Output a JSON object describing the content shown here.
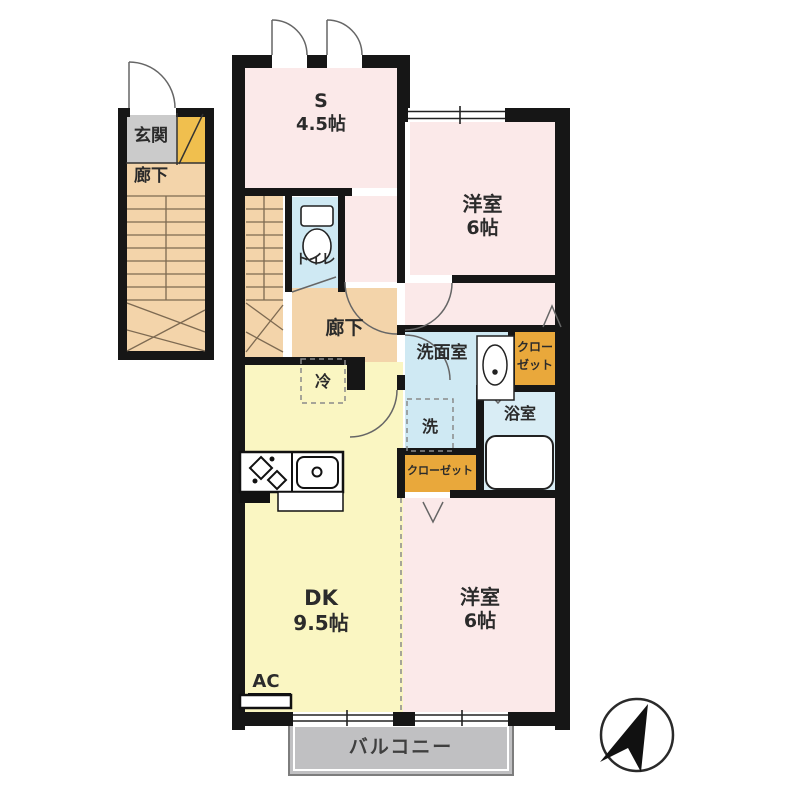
{
  "plan": {
    "type": "floorplan",
    "rooms": {
      "entrance": {
        "label": "玄関"
      },
      "entrance_hall": {
        "label": "廊下"
      },
      "service_room": {
        "name": "S",
        "size": "4.5帖"
      },
      "bedroom_top": {
        "name": "洋室",
        "size": "6帖"
      },
      "toilet": {
        "label": "トイレ"
      },
      "hallway": {
        "label": "廊下"
      },
      "washroom": {
        "label": "洗面室"
      },
      "closet_upper": {
        "label_line1": "クロー",
        "label_line2": "ゼット"
      },
      "bathroom": {
        "label": "浴室"
      },
      "laundry": {
        "label": "洗"
      },
      "refrigerator": {
        "label": "冷"
      },
      "closet_lower": {
        "label": "クローゼット"
      },
      "dining_kitchen": {
        "name": "DK",
        "size": "9.5帖"
      },
      "bedroom_bottom": {
        "name": "洋室",
        "size": "6帖"
      },
      "air_conditioner": {
        "label": "AC"
      },
      "balcony": {
        "label": "バルコニー"
      }
    },
    "colors": {
      "wall": "#161616",
      "bedroom_pink": "#fbe9e9",
      "dk_yellow": "#faf6c2",
      "hall_tan": "#f3d4aa",
      "wet_blue": "#cfe9f3",
      "bath_blue": "#d9edf5",
      "closet_orange": "#e9a83b",
      "entrance_gray": "#cbcbcb",
      "balcony_gray": "#c0c0c2"
    }
  }
}
